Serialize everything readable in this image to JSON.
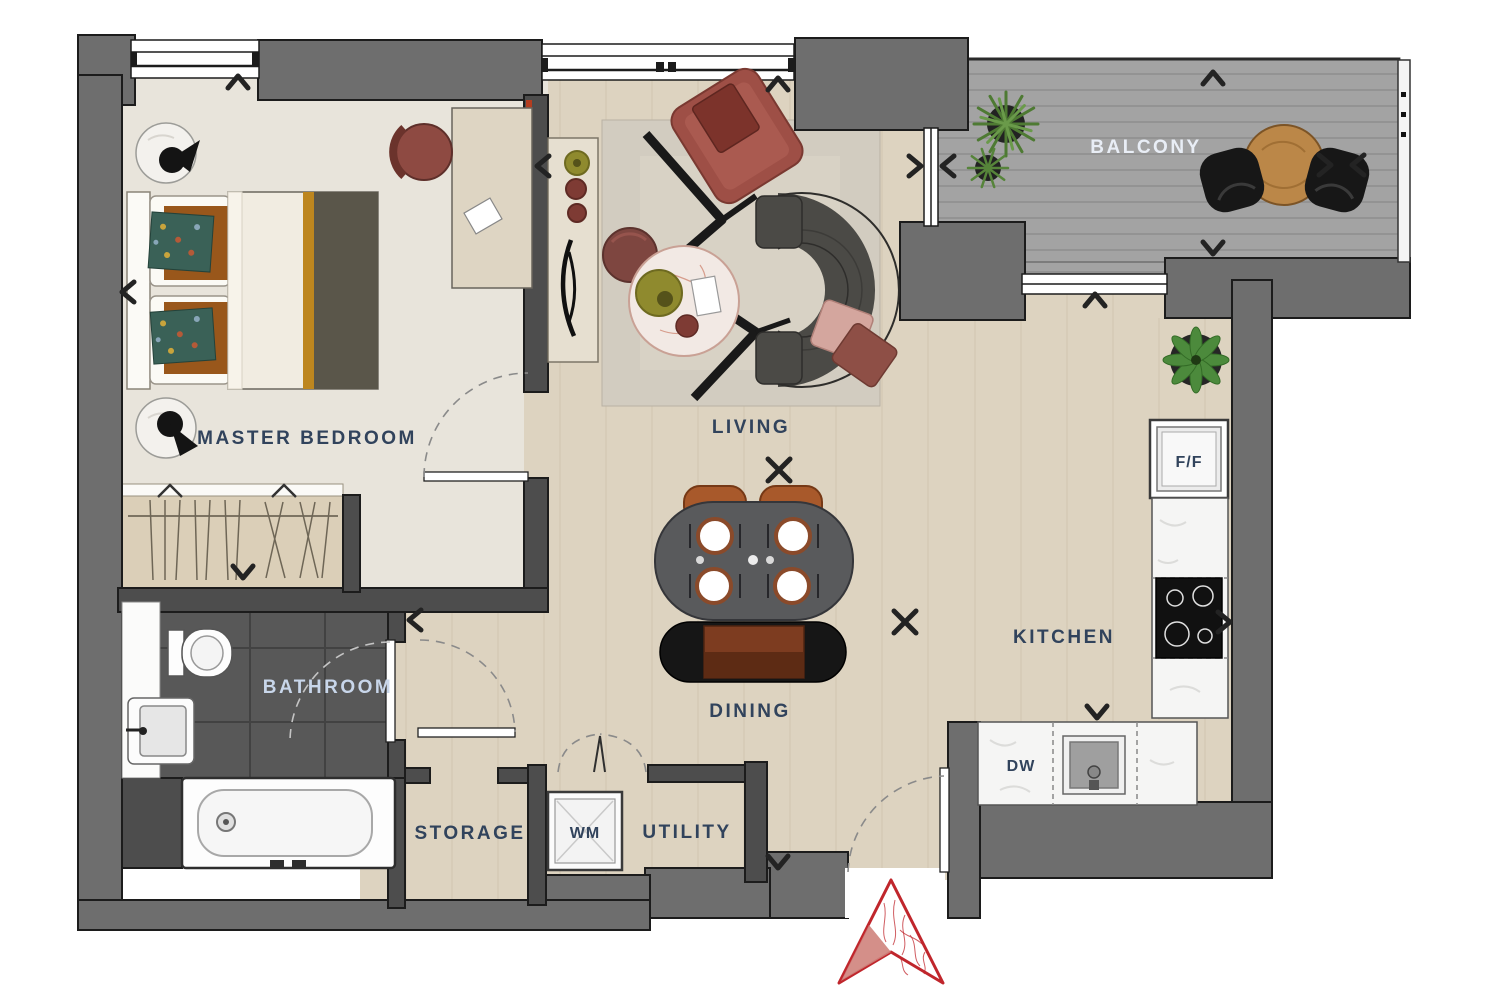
{
  "plan_type": "apartment-floor-plan",
  "rooms": {
    "master_bedroom": {
      "label": "MASTER BEDROOM"
    },
    "living": {
      "label": "LIVING"
    },
    "balcony": {
      "label": "BALCONY"
    },
    "kitchen": {
      "label": "KITCHEN"
    },
    "dining": {
      "label": "DINING"
    },
    "bathroom": {
      "label": "BATHROOM"
    },
    "storage": {
      "label": "STORAGE"
    },
    "utility": {
      "label": "UTILITY"
    }
  },
  "appliances": {
    "fridge_freezer": {
      "label": "F/F"
    },
    "washing_machine": {
      "label": "WM"
    },
    "dishwasher": {
      "label": "DW"
    }
  },
  "colors": {
    "wall_exterior": "#6e6e6e",
    "wall_interior": "#4d4d4d",
    "label_navy": "#31435c",
    "label_light": "#e9eef6",
    "wood_floor": "#ddd3c0",
    "bedroom_carpet": "#e8e4db",
    "bathroom_tile": "#585858",
    "balcony_deck": "#a3a3a3",
    "counter_marble": "#f5f5f4",
    "north_arrow_red": "#c0262c",
    "sofa_charcoal": "#4b4a46",
    "armchair_maroon": "#9e4f46",
    "chair_terracotta": "#a8592b",
    "bed_mustard": "#bd861f"
  }
}
